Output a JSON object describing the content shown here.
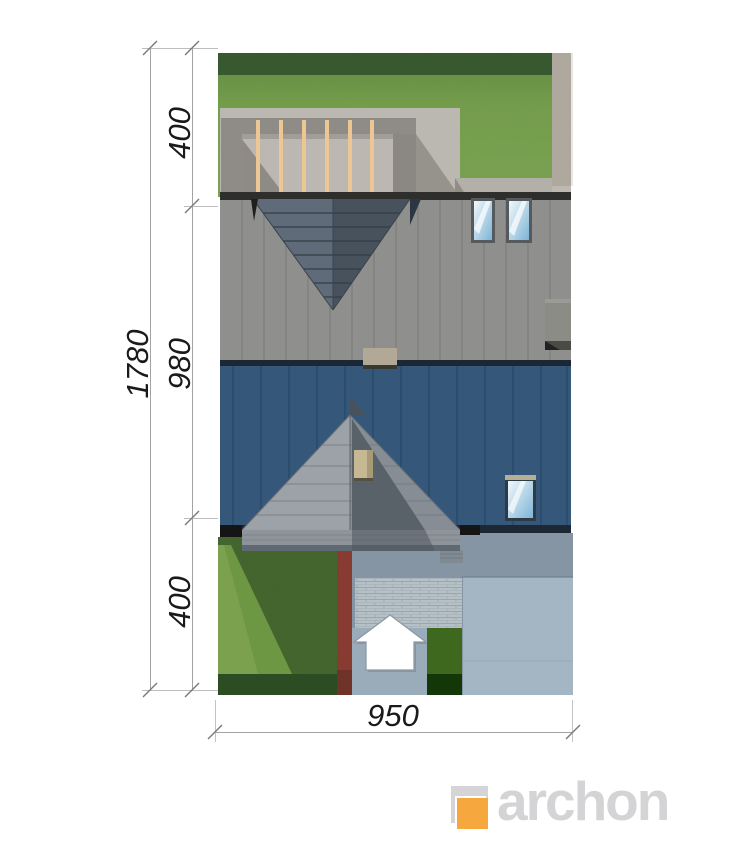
{
  "annotations": {
    "left": {
      "total_depth": "1780",
      "segments": [
        "400",
        "980",
        "400"
      ]
    },
    "bottom": {
      "plot_width": "950"
    }
  },
  "logo": {
    "text": "archon"
  },
  "icons": {
    "entrance_arrow": "entrance-arrow-icon"
  },
  "colors": {
    "accent_orange": "#f6a73e",
    "logo_gray": "#d5d5d7",
    "roof_gray": "#8f8f8d",
    "roof_blue": "#35587a",
    "dormer_blue_gray": "#5f6b79",
    "grass_green": "#74b039",
    "hedge_dark_green": "#1d4f12",
    "flower_red": "#9e2f1f",
    "paving_blue_gray": "#a4b5c3",
    "gravel_beige": "#cdc2ae",
    "pergola_beam_tan": "#ecc795",
    "dimension_text": "#1a1a1a"
  }
}
